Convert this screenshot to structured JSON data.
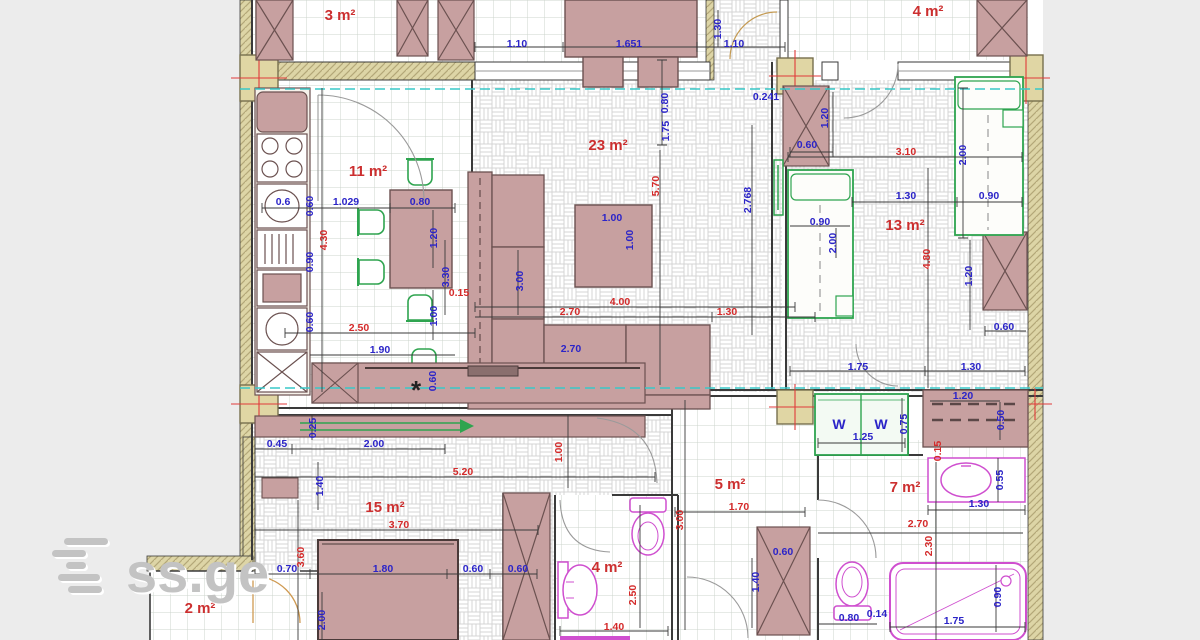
{
  "page": {
    "background": "#ececec",
    "plan_background": "#ffffff"
  },
  "logo": {
    "text": "ss.ge"
  },
  "watermark": {
    "text": "ss.ge"
  },
  "colors": {
    "dim_blue": "#2b24c8",
    "dim_red": "#d42a2a",
    "room_label_red": "#cc2f2f",
    "wall_tan": "#ddd5a6",
    "furniture_pink": "#c7a0a0",
    "fixture_magenta": "#cf4fcf",
    "furniture_green": "#2ea44f",
    "axis_teal": "#39c8c8"
  },
  "rooms": [
    {
      "label": "3 m²",
      "x": 340,
      "y": 20
    },
    {
      "label": "4 m²",
      "x": 928,
      "y": 16
    },
    {
      "label": "11 m²",
      "x": 368,
      "y": 176
    },
    {
      "label": "23 m²",
      "x": 608,
      "y": 150
    },
    {
      "label": "13 m²",
      "x": 905,
      "y": 230
    },
    {
      "label": "15 m²",
      "x": 385,
      "y": 512
    },
    {
      "label": "5 m²",
      "x": 730,
      "y": 489
    },
    {
      "label": "4 m²",
      "x": 607,
      "y": 572
    },
    {
      "label": "7 m²",
      "x": 905,
      "y": 492
    },
    {
      "label": "2 m²",
      "x": 200,
      "y": 613
    }
  ],
  "dimensions": [
    [
      "1.10",
      517,
      47,
      "b",
      0
    ],
    [
      "1.651",
      629,
      47,
      "b",
      0
    ],
    [
      "0.80",
      668,
      103,
      "b",
      1
    ],
    [
      "1.10",
      734,
      47,
      "b",
      0
    ],
    [
      "1.30",
      721,
      29,
      "b",
      1
    ],
    [
      "0.241",
      766,
      100,
      "b",
      0
    ],
    [
      "2.768",
      751,
      200,
      "b",
      1
    ],
    [
      "1.75",
      669,
      131,
      "b",
      1
    ],
    [
      "5.70",
      659,
      186,
      "r",
      1
    ],
    [
      "0.6",
      283,
      205,
      "b",
      0
    ],
    [
      "1.029",
      346,
      205,
      "b",
      0
    ],
    [
      "0.80",
      420,
      205,
      "b",
      0
    ],
    [
      "4.30",
      327,
      240,
      "r",
      1
    ],
    [
      "0.60",
      313,
      206,
      "b",
      1
    ],
    [
      "0.90",
      313,
      262,
      "b",
      1
    ],
    [
      "0.60",
      313,
      322,
      "b",
      1
    ],
    [
      "1.20",
      437,
      238,
      "b",
      1
    ],
    [
      "3.30",
      449,
      277,
      "b",
      1
    ],
    [
      "1.00",
      437,
      316,
      "b",
      1
    ],
    [
      "2.50",
      359,
      331,
      "r",
      0
    ],
    [
      "1.90",
      380,
      353,
      "b",
      0
    ],
    [
      "0.60",
      436,
      381,
      "b",
      1
    ],
    [
      "0.15",
      459,
      296,
      "r",
      0
    ],
    [
      "1.00",
      612,
      221,
      "b",
      0
    ],
    [
      "1.00",
      633,
      240,
      "b",
      1
    ],
    [
      "3.00",
      523,
      281,
      "b",
      1
    ],
    [
      "2.70",
      570,
      315,
      "r",
      0
    ],
    [
      "4.00",
      620,
      305,
      "r",
      0
    ],
    [
      "1.30",
      727,
      315,
      "r",
      0
    ],
    [
      "2.70",
      571,
      352,
      "b",
      0
    ],
    [
      "3.10",
      906,
      155,
      "r",
      0
    ],
    [
      "1.30",
      906,
      199,
      "b",
      0
    ],
    [
      "0.90",
      989,
      199,
      "b",
      0
    ],
    [
      "0.90",
      820,
      225,
      "b",
      0
    ],
    [
      "2.00",
      836,
      243,
      "b",
      1
    ],
    [
      "2.00",
      966,
      155,
      "b",
      1
    ],
    [
      "4.80",
      930,
      259,
      "r",
      1
    ],
    [
      "1.20",
      972,
      276,
      "b",
      1
    ],
    [
      "0.60",
      1004,
      330,
      "b",
      0
    ],
    [
      "1.20",
      828,
      118,
      "b",
      1
    ],
    [
      "0.60",
      807,
      148,
      "b",
      0
    ],
    [
      "1.75",
      858,
      370,
      "b",
      0
    ],
    [
      "1.30",
      971,
      370,
      "b",
      0
    ],
    [
      "0.45",
      277,
      447,
      "b",
      0
    ],
    [
      "2.00",
      374,
      447,
      "b",
      0
    ],
    [
      "0.25",
      316,
      428,
      "b",
      1
    ],
    [
      "1.40",
      323,
      486,
      "b",
      1
    ],
    [
      "5.20",
      463,
      475,
      "r",
      0
    ],
    [
      "1.00",
      562,
      452,
      "r",
      1
    ],
    [
      "3.70",
      399,
      528,
      "r",
      0
    ],
    [
      "3.60",
      304,
      557,
      "r",
      1
    ],
    [
      "0.70",
      287,
      572,
      "b",
      0
    ],
    [
      "1.80",
      383,
      572,
      "b",
      0
    ],
    [
      "0.60",
      473,
      572,
      "b",
      0
    ],
    [
      "0.60",
      518,
      572,
      "b",
      0
    ],
    [
      "2.00",
      325,
      620,
      "b",
      1
    ],
    [
      "2.50",
      636,
      595,
      "r",
      1
    ],
    [
      "1.40",
      614,
      630,
      "r",
      0
    ],
    [
      "1.70",
      739,
      510,
      "r",
      0
    ],
    [
      "3.00",
      683,
      520,
      "r",
      1
    ],
    [
      "1.40",
      759,
      582,
      "b",
      1
    ],
    [
      "0.60",
      783,
      555,
      "b",
      0
    ],
    [
      "1.25",
      863,
      440,
      "b",
      0
    ],
    [
      "0.75",
      907,
      424,
      "b",
      1
    ],
    [
      "1.20",
      963,
      399,
      "b",
      0
    ],
    [
      "0.50",
      1004,
      420,
      "b",
      1
    ],
    [
      "0.15",
      941,
      451,
      "r",
      1
    ],
    [
      "2.70",
      918,
      527,
      "r",
      0
    ],
    [
      "2.30",
      932,
      546,
      "r",
      1
    ],
    [
      "1.30",
      979,
      507,
      "b",
      0
    ],
    [
      "0.55",
      1003,
      480,
      "b",
      1
    ],
    [
      "1.75",
      954,
      624,
      "b",
      0
    ],
    [
      "0.90",
      1001,
      597,
      "b",
      1
    ],
    [
      "0.14",
      877,
      617,
      "b",
      0
    ],
    [
      "0.80",
      849,
      621,
      "b",
      0
    ]
  ],
  "symbols": [
    {
      "glyph": "W",
      "x": 839,
      "y": 429
    },
    {
      "glyph": "W",
      "x": 881,
      "y": 429
    }
  ],
  "star_symbol": {
    "glyph": "*",
    "x": 416,
    "y": 399
  }
}
